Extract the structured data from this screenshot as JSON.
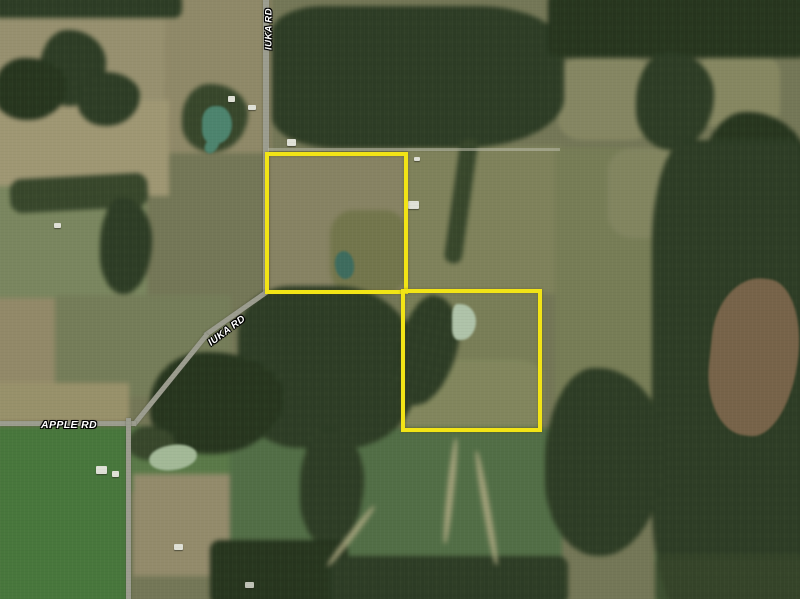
{
  "map": {
    "road_labels": [
      {
        "id": "iuka-rd-north",
        "text": "IUKA RD"
      },
      {
        "id": "iuka-rd-southwest",
        "text": "IUKA RD"
      },
      {
        "id": "apple-rd",
        "text": "APPLE RD"
      }
    ],
    "parcels": [
      {
        "id": "north-parcel",
        "outline_color": "#f2e416"
      },
      {
        "id": "south-parcel",
        "outline_color": "#f2e416"
      }
    ],
    "colors": {
      "parcel_outline": "#f2e416",
      "label_text": "#ffffff",
      "label_halo": "#000000"
    }
  }
}
